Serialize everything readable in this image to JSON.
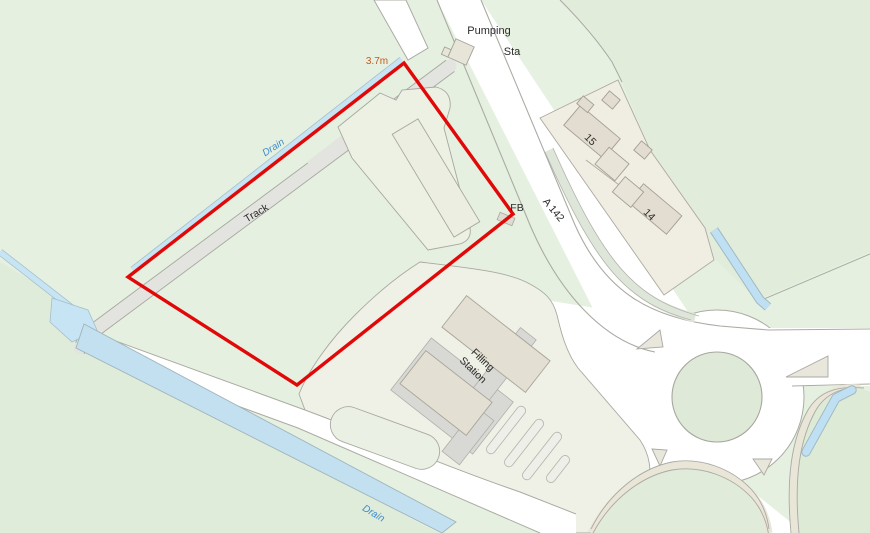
{
  "map": {
    "type": "ordnance-survey-site-plan",
    "labels": {
      "pumping_line1": "Pumping",
      "pumping_line2": "Sta",
      "spot_height": "3.7m",
      "drain_upper": "Drain",
      "drain_lower": "Drain",
      "track": "Track",
      "footbridge": "FB",
      "road_name": "A 142",
      "house_15": "15",
      "house_14": "14",
      "filling_line1": "Filling",
      "filling_line2": "Station"
    },
    "colors": {
      "site_boundary": "#e10808",
      "water_fill": "#c6e4f3",
      "field_green": "#e5f0e0",
      "road_white": "#ffffff",
      "building_beige": "#e2ddcf",
      "casing_grey": "#a9a9a3",
      "water_label": "#3f8ccb",
      "spot_height_label": "#c25b1e",
      "text_label": "#2b2b2b"
    }
  }
}
